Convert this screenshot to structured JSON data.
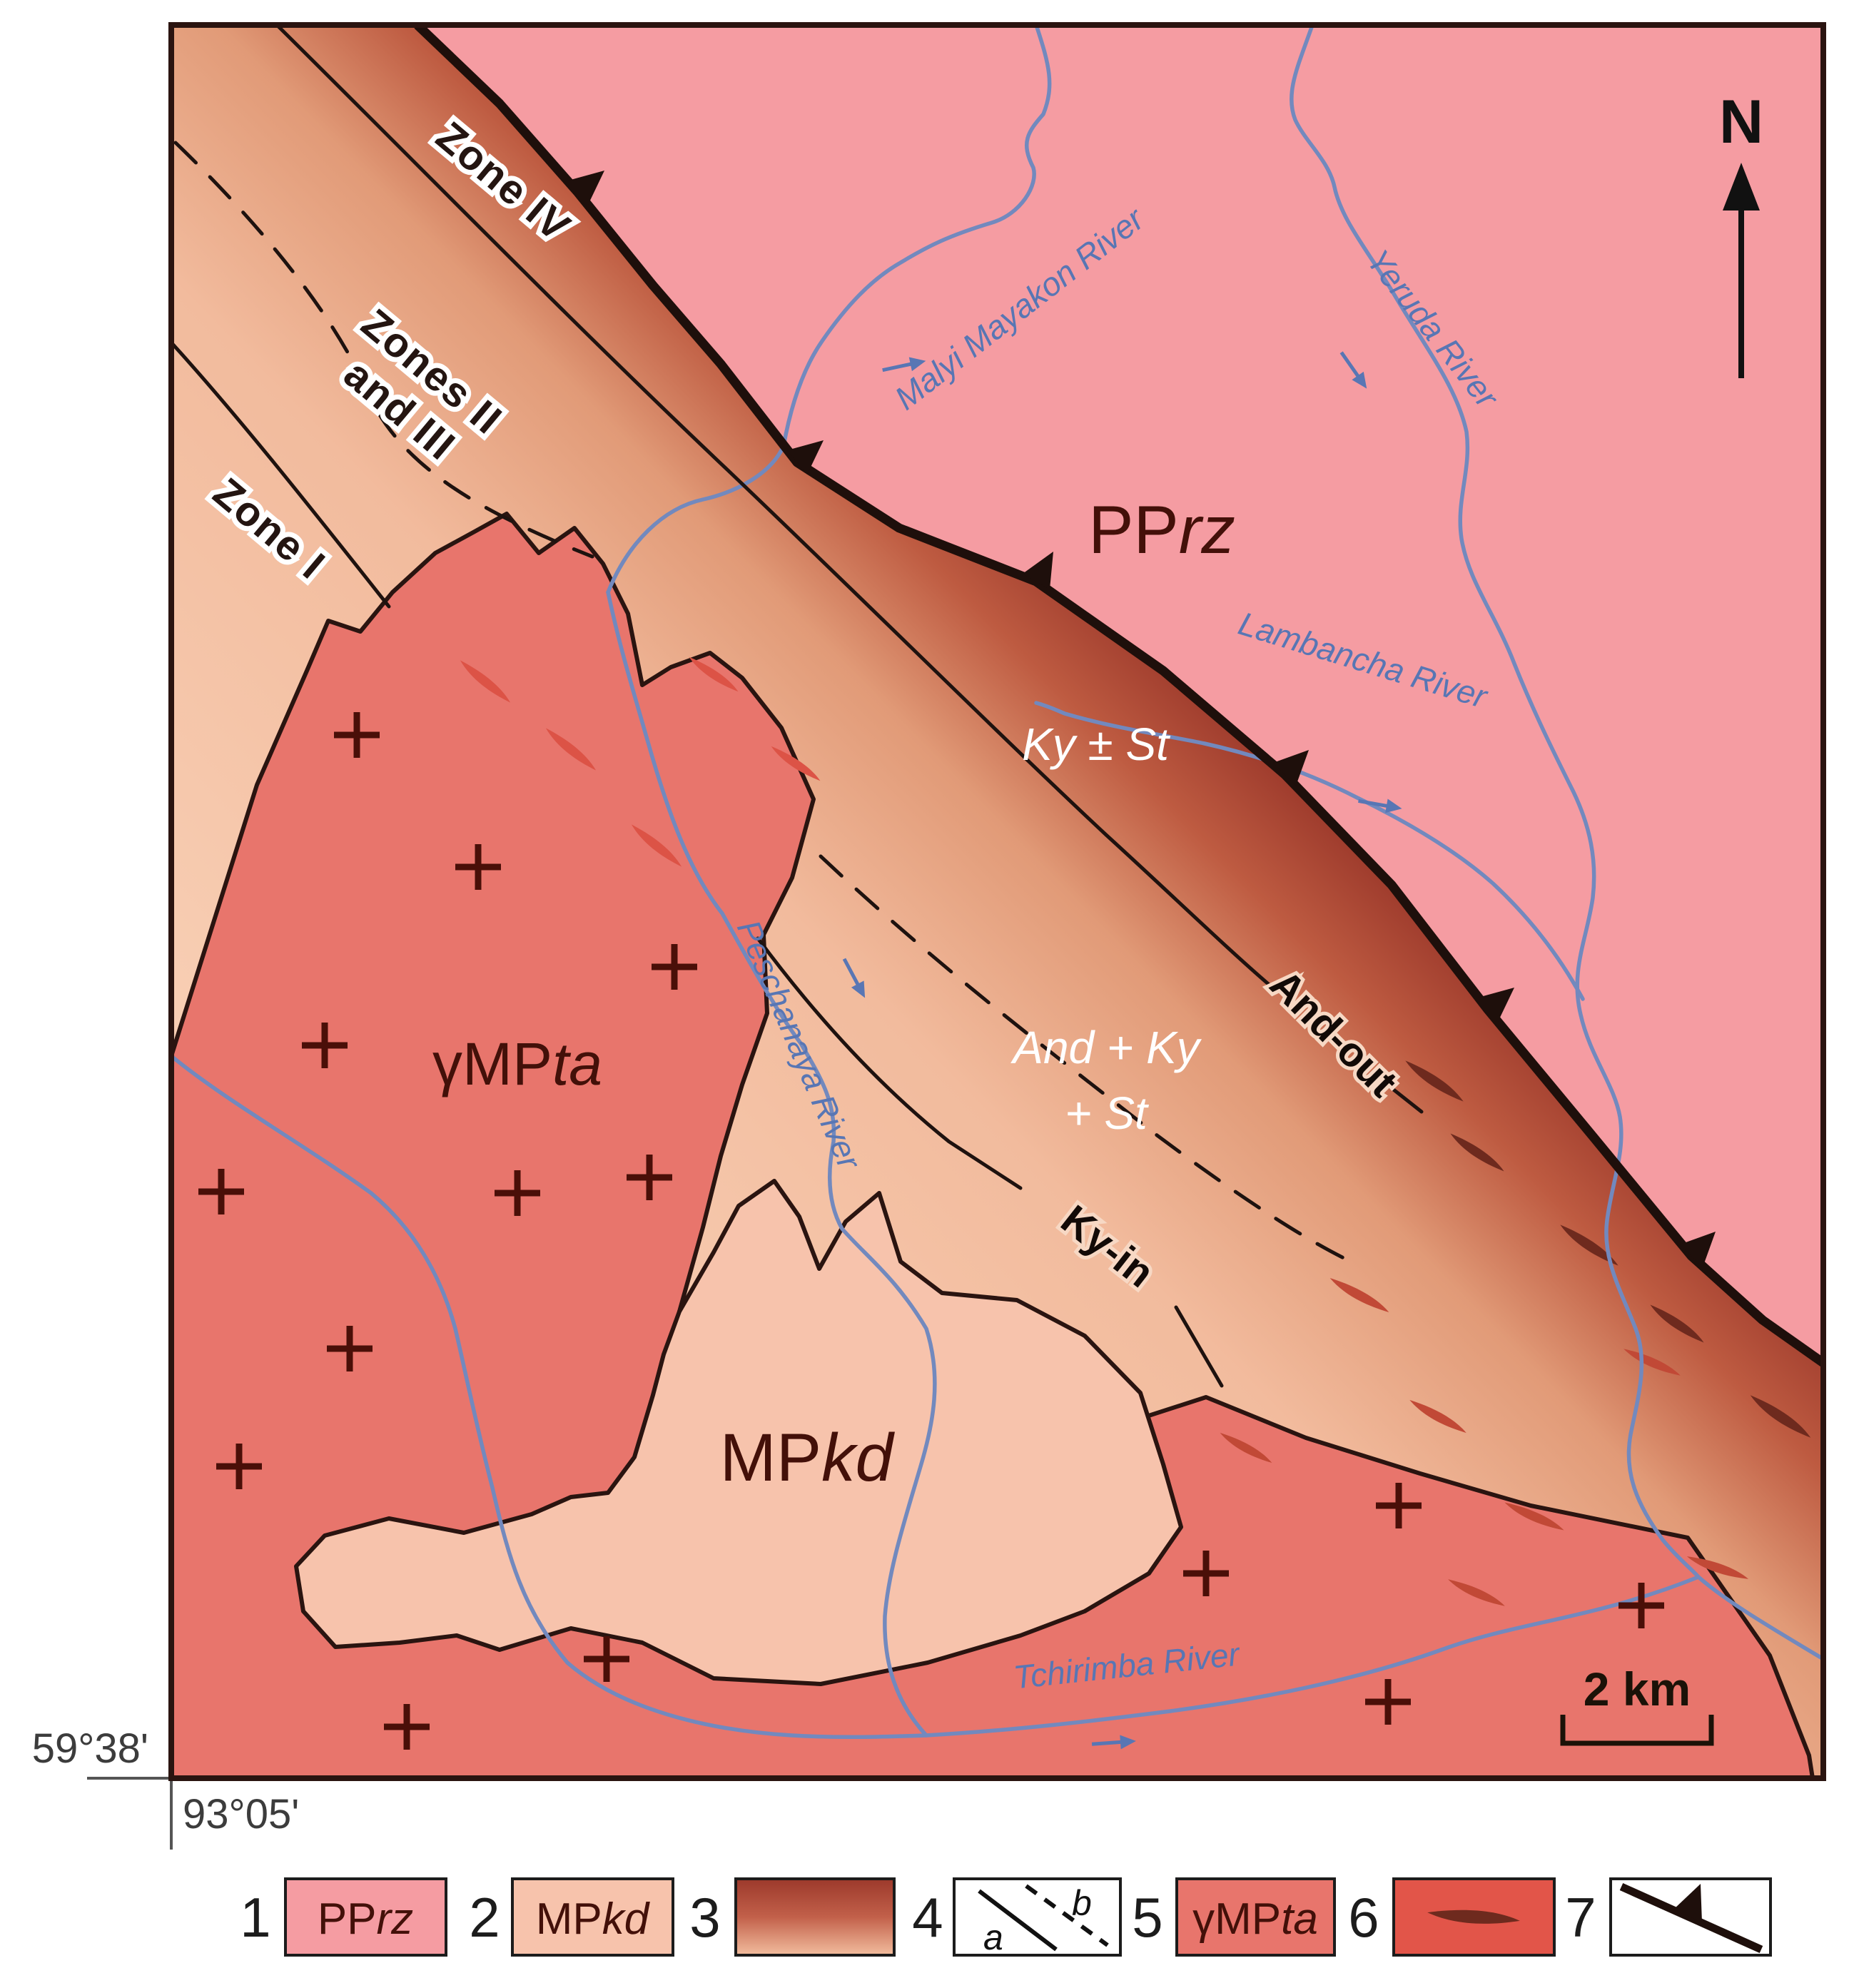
{
  "map": {
    "north_label": "N",
    "coordinates": {
      "latitude": "59°38'",
      "longitude": "93°05'"
    },
    "scale_bar": {
      "label": "2 km"
    },
    "zones": {
      "zone4": "Zone IV",
      "zones23_line1": "Zones II",
      "zones23_line2": "and III",
      "zone1": "Zone I"
    },
    "isograds": {
      "ky_st": "Ky ± St",
      "and_ky_line1": "And + Ky",
      "and_ky_line2": "+ St",
      "and_out": "And-out",
      "ky_in": "Ky-in"
    },
    "rivers": {
      "malyi_mayakon": "Malyi Mayakon River",
      "yeruda": "Yeruda River",
      "lambancha": "Lambancha River",
      "peschanaya": "Peschanaya River",
      "tchirimba": "Tchirimba River"
    }
  },
  "units": {
    "pprz": {
      "roman": "PP",
      "italic": "rz"
    },
    "mpkd": {
      "roman": "MP",
      "italic": "kd"
    },
    "ympta": {
      "roman": "γMP",
      "italic": "ta"
    }
  },
  "legend": {
    "items": [
      {
        "number": "1",
        "meaning": "PPrz unit (pink)"
      },
      {
        "number": "2",
        "meaning": "MPkd unit (light peach)"
      },
      {
        "number": "3",
        "meaning": "metamorphic zoning gradient"
      },
      {
        "number": "4",
        "meaning": "boundaries: a solid, b dashed",
        "a": "a",
        "b": "b"
      },
      {
        "number": "5",
        "meaning": "γMPta granite (salmon)"
      },
      {
        "number": "6",
        "meaning": "dike / lens bodies"
      },
      {
        "number": "7",
        "meaning": "thrust fault with teeth"
      }
    ]
  },
  "colors": {
    "pprz": "#F59CA2",
    "mpkd": "#F7C3AC",
    "pluton": "#E8756C",
    "band_light": "#F9D2B8",
    "band_dark": "#9C392B",
    "river": "#7289BE",
    "fault": "#1E0F0B",
    "lens_dark": "#6E2A1E",
    "lens_medium": "#C14936",
    "lens_light": "#DC5346"
  }
}
